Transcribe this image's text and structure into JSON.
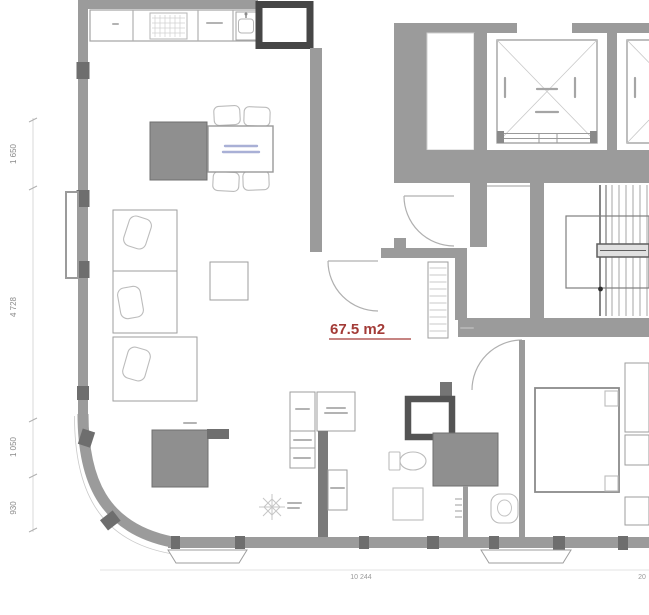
{
  "floor_plan": {
    "type": "apartment-floor-plan",
    "area_label": "67.5 m2",
    "dimensions_left": [
      {
        "label": "1 650"
      },
      {
        "label": "4 728"
      },
      {
        "label": "1 050"
      },
      {
        "label": "930"
      }
    ],
    "dimensions_bottom": [
      {
        "label": "10 244"
      },
      {
        "label": "20"
      }
    ],
    "colors": {
      "background": "#ffffff",
      "wall": "#9b9b9b",
      "wall_dark": "#4a4a4a",
      "furniture_fill": "#8f8f8f",
      "outline_light": "#bcbcbc",
      "area_label_color": "#a33b37",
      "dimension_text": "#8a8a8a",
      "table_label": "#a9b0d6"
    }
  }
}
